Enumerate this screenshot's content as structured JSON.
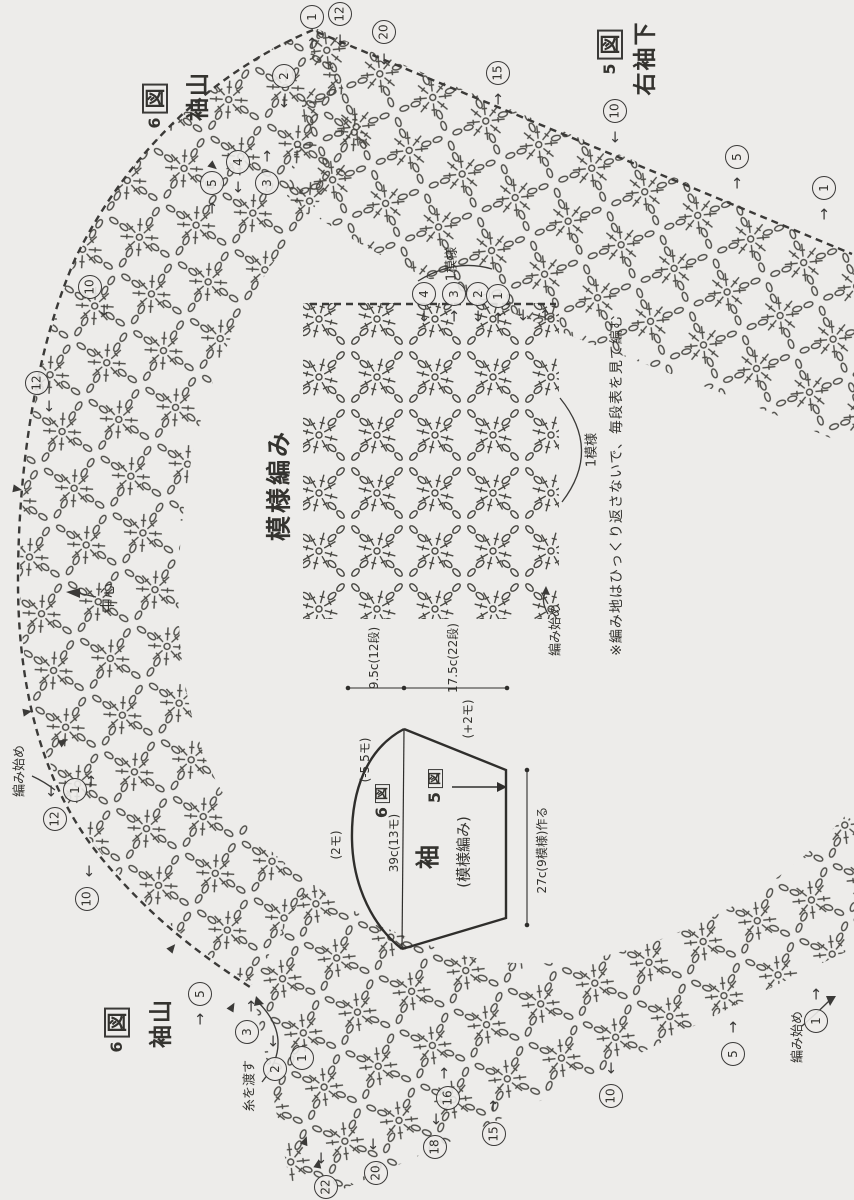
{
  "page": {
    "bg": "#edecea",
    "ink": "#45443f"
  },
  "labels": {
    "fig6_top": {
      "num": "6",
      "box": "図",
      "sub": "袖山"
    },
    "fig5_top": {
      "num": "5",
      "box": "図",
      "sub": "右袖下"
    },
    "fig6_bottom": {
      "num": "6",
      "box": "図",
      "sub": "袖山"
    },
    "swatch_title": "模様編み",
    "one_pattern_top": "1模様",
    "one_pattern_right": "1模様",
    "center": "中心",
    "start_left": "編み始め",
    "start_swatch": "編み始め",
    "start_bottom": "編み始め",
    "carry_yarn": "糸を渡す",
    "note": "※編み地はひっくり返さないで、毎段表を見て編む"
  },
  "schematic": {
    "fig6_num": "6",
    "fig6_box": "図",
    "fig5_num": "5",
    "fig5_box": "図",
    "title": "袖",
    "subtitle": "(模様編み)",
    "chord": "39c(13モ)",
    "cuff": "27c(9模様)作る",
    "cap_height": "9.5c(12段)",
    "length": "17.5c(22段)",
    "top_count": "(2モ)",
    "cap_dec": "(-5.5モ)",
    "underarm_inc": "(+2モ)"
  },
  "markers": [
    {
      "n": "2",
      "x": 283,
      "y": 75,
      "a": "↓",
      "ax": 0,
      "ay": 27
    },
    {
      "n": "1",
      "x": 311,
      "y": 16,
      "a": "↑",
      "ax": 0,
      "ay": 27
    },
    {
      "n": "12",
      "x": 339,
      "y": 13,
      "a": "↓",
      "ax": 0,
      "ay": 27
    },
    {
      "n": "20",
      "x": 383,
      "y": 31,
      "a": "↓",
      "ax": 0,
      "ay": 28
    },
    {
      "n": "15",
      "x": 497,
      "y": 72,
      "a": "↑",
      "ax": 0,
      "ay": 27
    },
    {
      "n": "10",
      "x": 614,
      "y": 110,
      "a": "↓",
      "ax": 0,
      "ay": 27
    },
    {
      "n": "5",
      "x": 736,
      "y": 156,
      "a": "↑",
      "ax": 0,
      "ay": 27
    },
    {
      "n": "1",
      "x": 823,
      "y": 187,
      "a": "↑",
      "ax": 0,
      "ay": 27
    },
    {
      "n": "4",
      "x": 237,
      "y": 161,
      "a": "↓",
      "ax": 0,
      "ay": 26
    },
    {
      "n": "5",
      "x": 211,
      "y": 182,
      "a": "↑",
      "ax": 0,
      "ay": 26
    },
    {
      "n": "3",
      "x": 266,
      "y": 182,
      "a": "↑",
      "ax": 0,
      "ay": -26
    },
    {
      "n": "10",
      "x": 89,
      "y": 286,
      "a": "↓",
      "ax": 14,
      "ay": 24
    },
    {
      "n": "12",
      "x": 36,
      "y": 382,
      "a": "↓",
      "ax": 12,
      "ay": 24
    },
    {
      "n": "1",
      "x": 74,
      "y": 789,
      "a": "↑",
      "ax": 16,
      "ay": -8
    },
    {
      "n": "12",
      "x": 54,
      "y": 818,
      "a": "↓",
      "ax": -4,
      "ay": -27
    },
    {
      "n": "10",
      "x": 86,
      "y": 898,
      "a": "↓",
      "ax": 2,
      "ay": -27
    },
    {
      "n": "5",
      "x": 199,
      "y": 993,
      "a": "↑",
      "ax": 0,
      "ay": 26
    },
    {
      "n": "3",
      "x": 246,
      "y": 1031,
      "a": "↑",
      "ax": 4,
      "ay": -25
    },
    {
      "n": "2",
      "x": 274,
      "y": 1068,
      "a": "↓",
      "ax": -2,
      "ay": -27
    },
    {
      "n": "1",
      "x": 301,
      "y": 1057,
      "a": "",
      "ax": 0,
      "ay": 0
    },
    {
      "n": "22",
      "x": 325,
      "y": 1186,
      "a": "↓",
      "ax": -5,
      "ay": -28
    },
    {
      "n": "20",
      "x": 375,
      "y": 1172,
      "a": "↓",
      "ax": -3,
      "ay": -28
    },
    {
      "n": "18",
      "x": 434,
      "y": 1146,
      "a": "↓",
      "ax": 1,
      "ay": -27
    },
    {
      "n": "15",
      "x": 493,
      "y": 1133,
      "a": "↑",
      "ax": -1,
      "ay": -27
    },
    {
      "n": "16",
      "x": 447,
      "y": 1097,
      "a": "↑",
      "ax": -4,
      "ay": -24
    },
    {
      "n": "10",
      "x": 610,
      "y": 1095,
      "a": "↓",
      "ax": 0,
      "ay": -27
    },
    {
      "n": "5",
      "x": 732,
      "y": 1053,
      "a": "↑",
      "ax": 0,
      "ay": -26
    },
    {
      "n": "1",
      "x": 815,
      "y": 1020,
      "a": "↑",
      "ax": 0,
      "ay": -26
    },
    {
      "n": "4",
      "x": 423,
      "y": 293,
      "a": "↓",
      "ax": 0,
      "ay": 23
    },
    {
      "n": "3",
      "x": 453,
      "y": 293,
      "a": "↑",
      "ax": 0,
      "ay": 23
    },
    {
      "n": "2",
      "x": 477,
      "y": 293,
      "a": "↓",
      "ax": 0,
      "ay": 23
    },
    {
      "n": "1",
      "x": 497,
      "y": 295,
      "a": "↑",
      "ax": 0,
      "ay": 23
    }
  ],
  "extra_arrows": [
    {
      "x": 523,
      "y": 316,
      "a": "↓"
    },
    {
      "x": 545,
      "y": 316,
      "a": "↑"
    }
  ]
}
